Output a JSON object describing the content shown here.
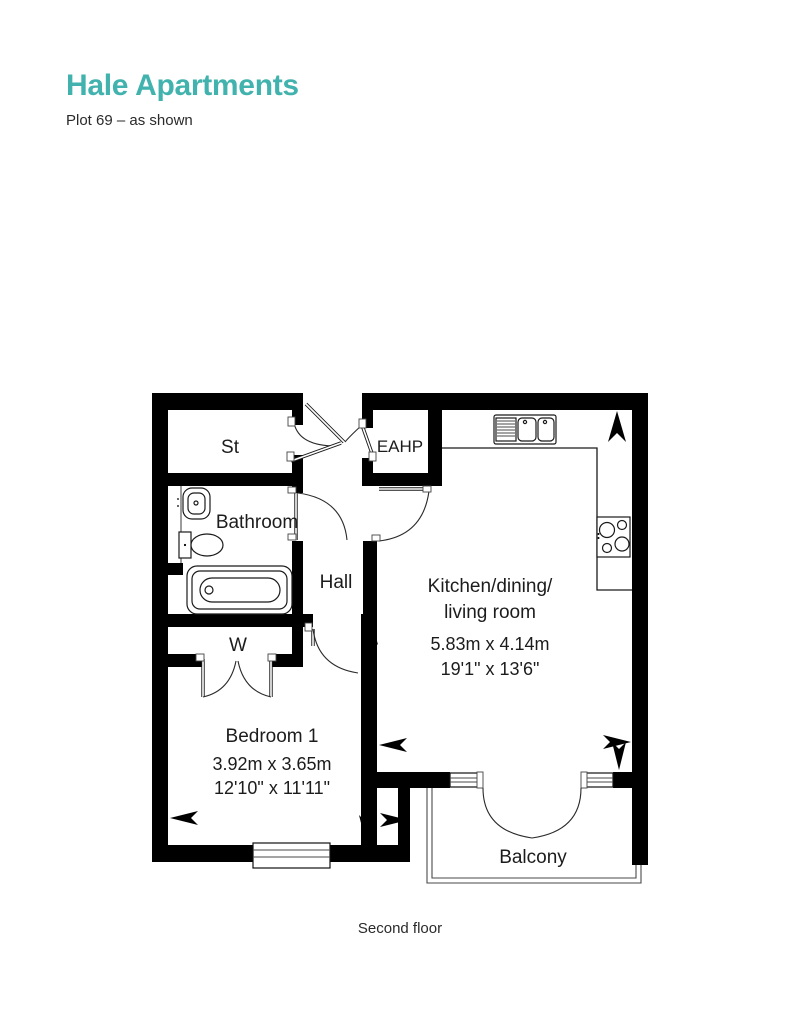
{
  "header": {
    "title": "Hale Apartments",
    "subtitle": "Plot 69 – as shown"
  },
  "colors": {
    "accent_teal": "#41b2ad",
    "wall_black": "#000000",
    "text_dark": "#2a2a2a"
  },
  "floorplan": {
    "rooms": {
      "storage": {
        "label": "St"
      },
      "eahp": {
        "label": "EAHP"
      },
      "bathroom": {
        "label": "Bathroom"
      },
      "hall": {
        "label": "Hall"
      },
      "kitchen": {
        "label_line1": "Kitchen/dining/",
        "label_line2": "living room",
        "dims_metric": "5.83m x 4.14m",
        "dims_imperial": "19'1\" x 13'6\""
      },
      "wardrobe": {
        "label": "W"
      },
      "bedroom": {
        "label": "Bedroom 1",
        "dims_metric": "3.92m x 3.65m",
        "dims_imperial": "12'10\" x 11'11\""
      },
      "balcony": {
        "label": "Balcony"
      }
    }
  },
  "footer": {
    "floor_label": "Second floor"
  }
}
